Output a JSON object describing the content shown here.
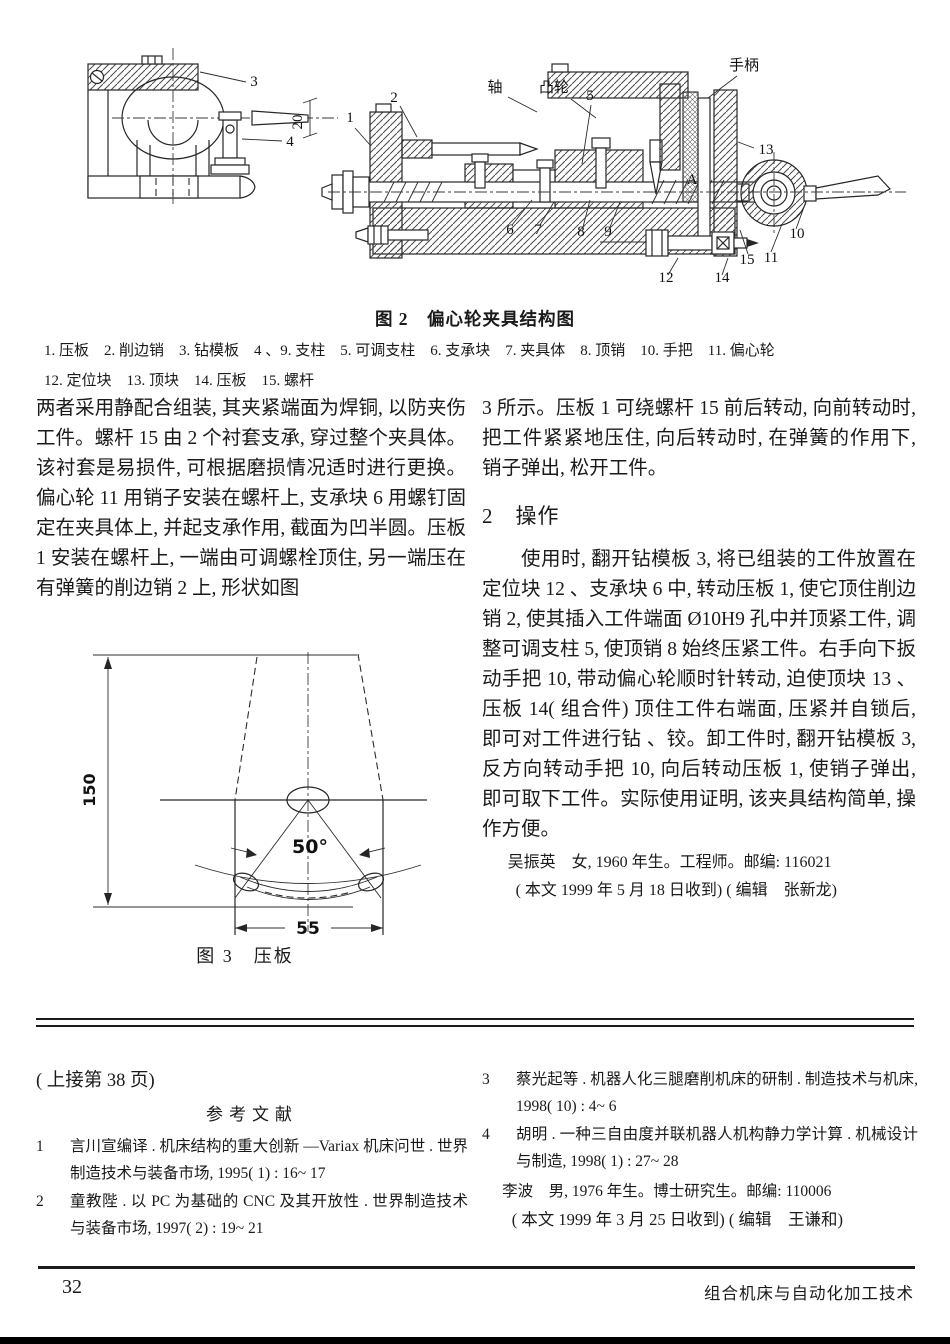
{
  "figure2": {
    "caption": "图 2　偏心轮夹具结构图",
    "parts_line1": "1. 压板　2. 削边销　3. 钻模板　4 、9. 支柱　5. 可调支柱　6. 支承块　7. 夹具体　8. 顶销　10. 手把　11. 偏心轮",
    "parts_line2": "12. 定位块　13. 顶块　14. 压板　15. 螺杆",
    "annotations": [
      {
        "text": "3",
        "x": 214,
        "y": 44
      },
      {
        "text": "20",
        "x": 262,
        "y": 80,
        "rot": true
      },
      {
        "text": "4",
        "x": 250,
        "y": 104
      },
      {
        "text": "1",
        "x": 310,
        "y": 80
      },
      {
        "text": "2",
        "x": 354,
        "y": 60
      },
      {
        "text": "轴",
        "x": 455,
        "y": 50
      },
      {
        "text": "凸轮",
        "x": 514,
        "y": 50
      },
      {
        "text": "5",
        "x": 550,
        "y": 58
      },
      {
        "text": "手柄",
        "x": 704,
        "y": 28
      },
      {
        "text": "13",
        "x": 726,
        "y": 112
      },
      {
        "text": "A",
        "x": 652,
        "y": 142
      },
      {
        "text": "6",
        "x": 470,
        "y": 192
      },
      {
        "text": "7",
        "x": 498,
        "y": 192
      },
      {
        "text": "8",
        "x": 541,
        "y": 194
      },
      {
        "text": "9",
        "x": 568,
        "y": 194
      },
      {
        "text": "10",
        "x": 757,
        "y": 196
      },
      {
        "text": "11",
        "x": 731,
        "y": 220
      },
      {
        "text": "15",
        "x": 707,
        "y": 222
      },
      {
        "text": "12",
        "x": 626,
        "y": 240
      },
      {
        "text": "14",
        "x": 682,
        "y": 240
      }
    ]
  },
  "body": {
    "left_para": "两者采用静配合组装, 其夹紧端面为焊铜, 以防夹伤工件。螺杆 15 由 2 个衬套支承, 穿过整个夹具体。该衬套是易损件, 可根据磨损情况适时进行更换。偏心轮 11 用销子安装在螺杆上, 支承块 6 用螺钉固定在夹具体上, 并起支承作用, 截面为凹半圆。压板 1 安装在螺杆上, 一端由可调螺栓顶住, 另一端压在有弹簧的削边销 2 上, 形状如图",
    "right_para": "3 所示。压板 1 可绕螺杆 15 前后转动, 向前转动时, 把工件紧紧地压住, 向后转动时, 在弹簧的作用下, 销子弹出, 松开工件。",
    "section_number": "2",
    "section_title": "操作",
    "operation_para": "使用时, 翻开钻模板 3, 将已组装的工件放置在定位块 12 、支承块 6 中, 转动压板 1, 使它顶住削边销 2, 使其插入工件端面 Ø10H9 孔中并顶紧工件, 调整可调支柱 5, 使顶销 8 始终压紧工件。右手向下扳动手把 10, 带动偏心轮顺时针转动, 迫使顶块 13 、压板 14( 组合件) 顶住工件右端面, 压紧并自锁后, 即可对工件进行钻 、铰。卸工件时, 翻开钻模板 3, 反方向转动手把 10, 向后转动压板 1, 使销子弹出, 即可取下工件。实际使用证明, 该夹具结构简单, 操作方便。",
    "author_info": "吴振英　女, 1960 年生。工程师。邮编: 116021",
    "received_note": "( 本文 1999 年 5 月 18 日收到) ( 编辑　张新龙)"
  },
  "figure3": {
    "caption": "图 3　压板",
    "dim_height": "150",
    "dim_angle": "50°",
    "dim_width": "55"
  },
  "continued": {
    "note": "( 上接第 38 页)",
    "ref_title": "参考文献",
    "refs_left": [
      {
        "num": "1",
        "text": "言川宣编译 . 机床结构的重大创新 —Variax 机床问世 . 世界制造技术与装备市场, 1995( 1) : 16~ 17"
      },
      {
        "num": "2",
        "text": "童教陛 . 以 PC 为基础的 CNC 及其开放性 . 世界制造技术与装备市场, 1997( 2) : 19~ 21"
      }
    ],
    "refs_right": [
      {
        "num": "3",
        "text": "蔡光起等 . 机器人化三腿磨削机床的研制 . 制造技术与机床, 1998( 10) : 4~ 6"
      },
      {
        "num": "4",
        "text": "胡明 . 一种三自由度并联机器人机构静力学计算 . 机械设计与制造, 1998( 1) : 27~ 28"
      }
    ],
    "bio": "李波　男, 1976 年生。博士研究生。邮编: 110006",
    "received_note": "( 本文 1999 年 3 月 25 日收到) ( 编辑　王谦和)"
  },
  "footer": {
    "page_number": "32",
    "journal_name": "组合机床与自动化加工技术"
  }
}
